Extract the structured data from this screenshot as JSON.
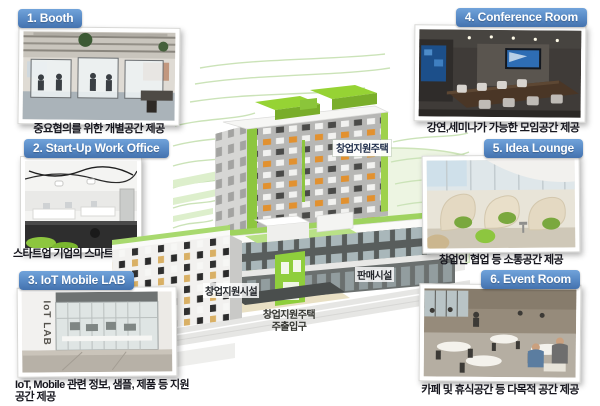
{
  "panels": [
    {
      "title": "1. Booth",
      "caption": "중요협의를 위한 개별공간 제공"
    },
    {
      "title": "2. Start-Up Work Office",
      "caption": "스타트업 기업의 스마트 사무공간 제공"
    },
    {
      "title": "3. IoT Mobile LAB",
      "caption": "IoT, Mobile 관련 정보, 샘플, 제품 등 지원공간 제공"
    },
    {
      "title": "4. Conference Room",
      "caption": "강연,세미나가 가능한 모임공간 제공"
    },
    {
      "title": "5. Idea Lounge",
      "caption": "창업인 협업 등 소통공간 제공"
    },
    {
      "title": "6. Event Room",
      "caption": "카페 및 휴식공간 등 다목적 공간 제공"
    }
  ],
  "building": {
    "tower_label": "창업지원주택",
    "support_facility_label": "창업지원시설",
    "retail_label": "판매시설",
    "entrance_label_line1": "창업지원주택",
    "entrance_label_line2": "주출입구"
  },
  "photos": {
    "iot_wall_text": "IoT LAB"
  },
  "colors": {
    "header_blue": "#5688c4",
    "accent_green": "#8dc63f",
    "caption_text": "#17171f",
    "label_text": "#1e2c49"
  }
}
